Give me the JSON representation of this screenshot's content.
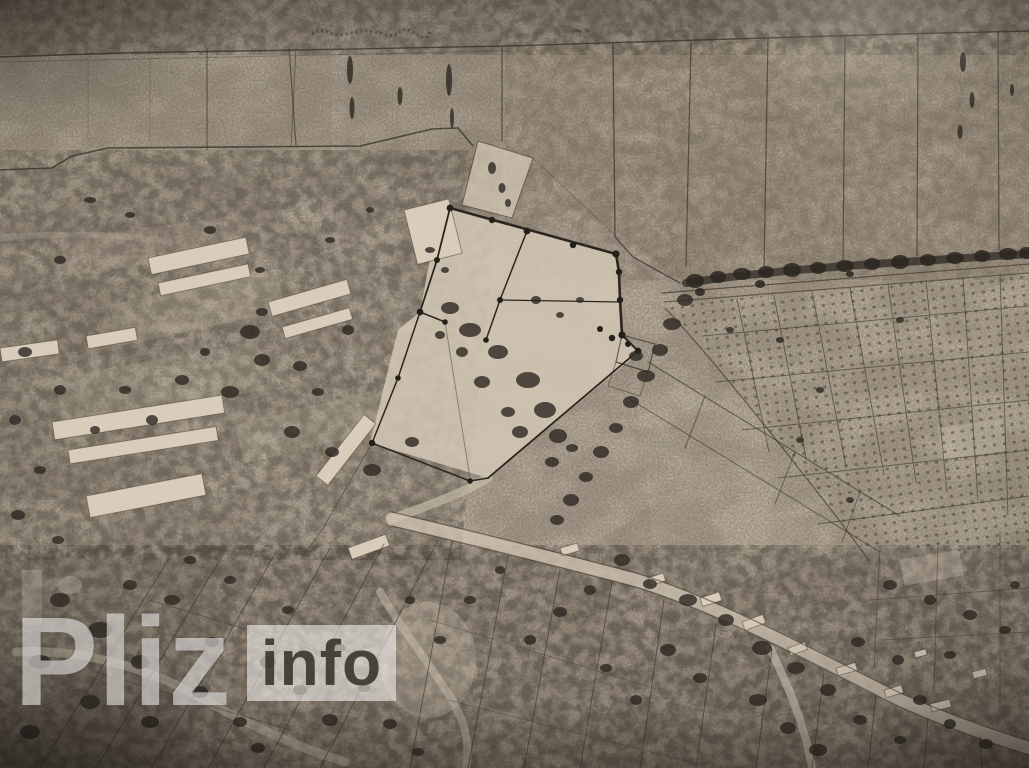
{
  "watermark": {
    "brand": "Pliz",
    "suffix": "info"
  },
  "map": {
    "kind": "monochrome aerial photograph / cadastral plan (photographed paper print)",
    "features": [
      "field-strip-parcels-top",
      "survey-boundary-with-corner-dots",
      "farm-building-blocks",
      "tree-line",
      "orchard-parcel-grid",
      "main-diagonal-road",
      "village-parcels-bottom"
    ]
  },
  "palette": {
    "paper": "#b2a695",
    "paper_light": "#d4c8b6",
    "paper_dark": "#8f8578",
    "ink": "#3b342b",
    "vegetation": "#2d2822",
    "watermark_text": "rgba(255,255,255,0.52)",
    "info_box_bg": "rgba(252,252,248,0.55)",
    "info_text": "rgba(44,38,32,0.82)"
  }
}
